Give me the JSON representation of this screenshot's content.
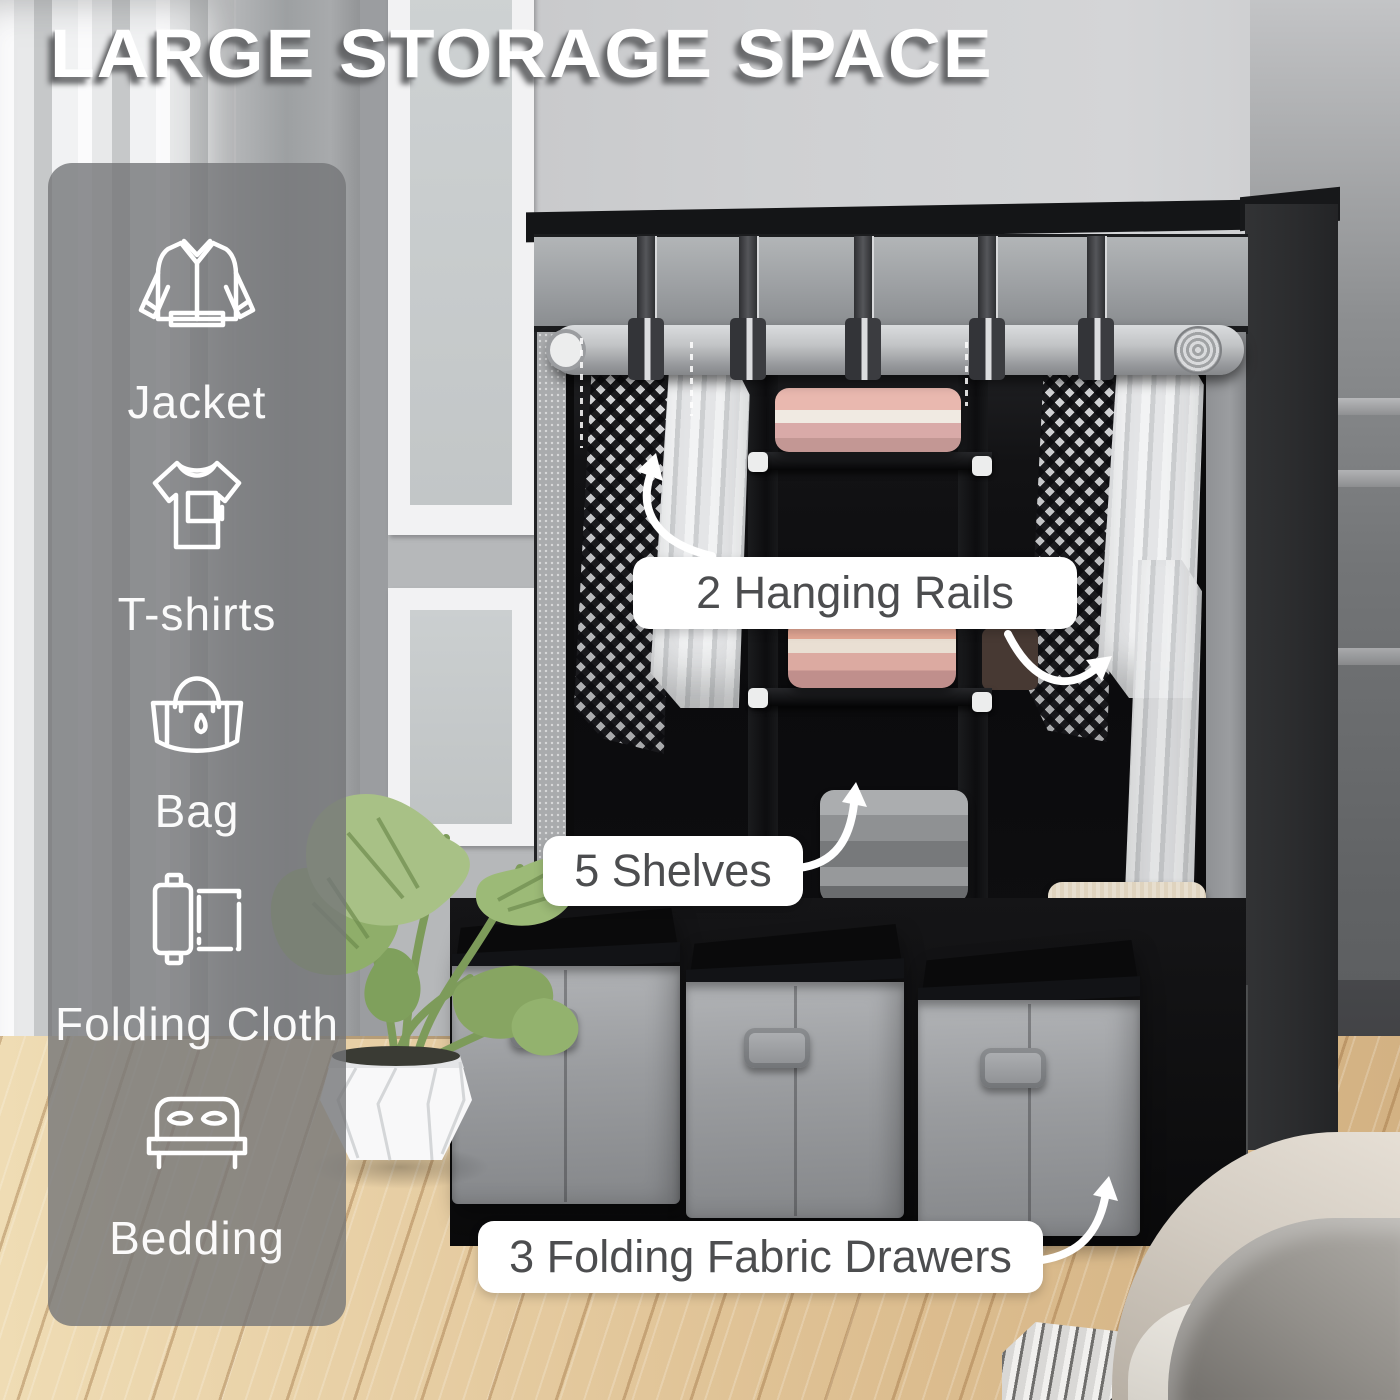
{
  "title": "LARGE STORAGE SPACE",
  "sidebar": {
    "items": [
      {
        "icon": "jacket-icon",
        "label": "Jacket"
      },
      {
        "icon": "tshirt-icon",
        "label": "T-shirts"
      },
      {
        "icon": "bag-icon",
        "label": "Bag"
      },
      {
        "icon": "folding-cloth-icon",
        "label": "Folding Cloth"
      },
      {
        "icon": "bedding-icon",
        "label": "Bedding"
      }
    ]
  },
  "callouts": [
    {
      "id": "hanging-rails",
      "label": "2 Hanging Rails"
    },
    {
      "id": "shelves",
      "label": "5 Shelves"
    },
    {
      "id": "fabric-drawers",
      "label": "3 Folding Fabric Drawers"
    }
  ],
  "colors": {
    "title_text": "#ffffff",
    "title_shadow": "#616264",
    "callout_bg": "#ffffff",
    "callout_text": "#4c4d4f",
    "sidebar_bg": "rgba(116,118,120,0.80)",
    "sidebar_text": "#ffffff",
    "wardrobe_cover_gray": "#9da0a3",
    "wardrobe_interior_black": "#0b0b0d",
    "drawer_front_gray": "#9a9c9f",
    "folded_clothes_pink": "#e0a89f",
    "folded_clothes_gray": "#8f9193",
    "folded_clothes_beige": "#d0c1a9",
    "floor_wood": "#e0c59c",
    "leaf_green": "#a2bd7e",
    "wall_gray": "#c6c7c9"
  }
}
